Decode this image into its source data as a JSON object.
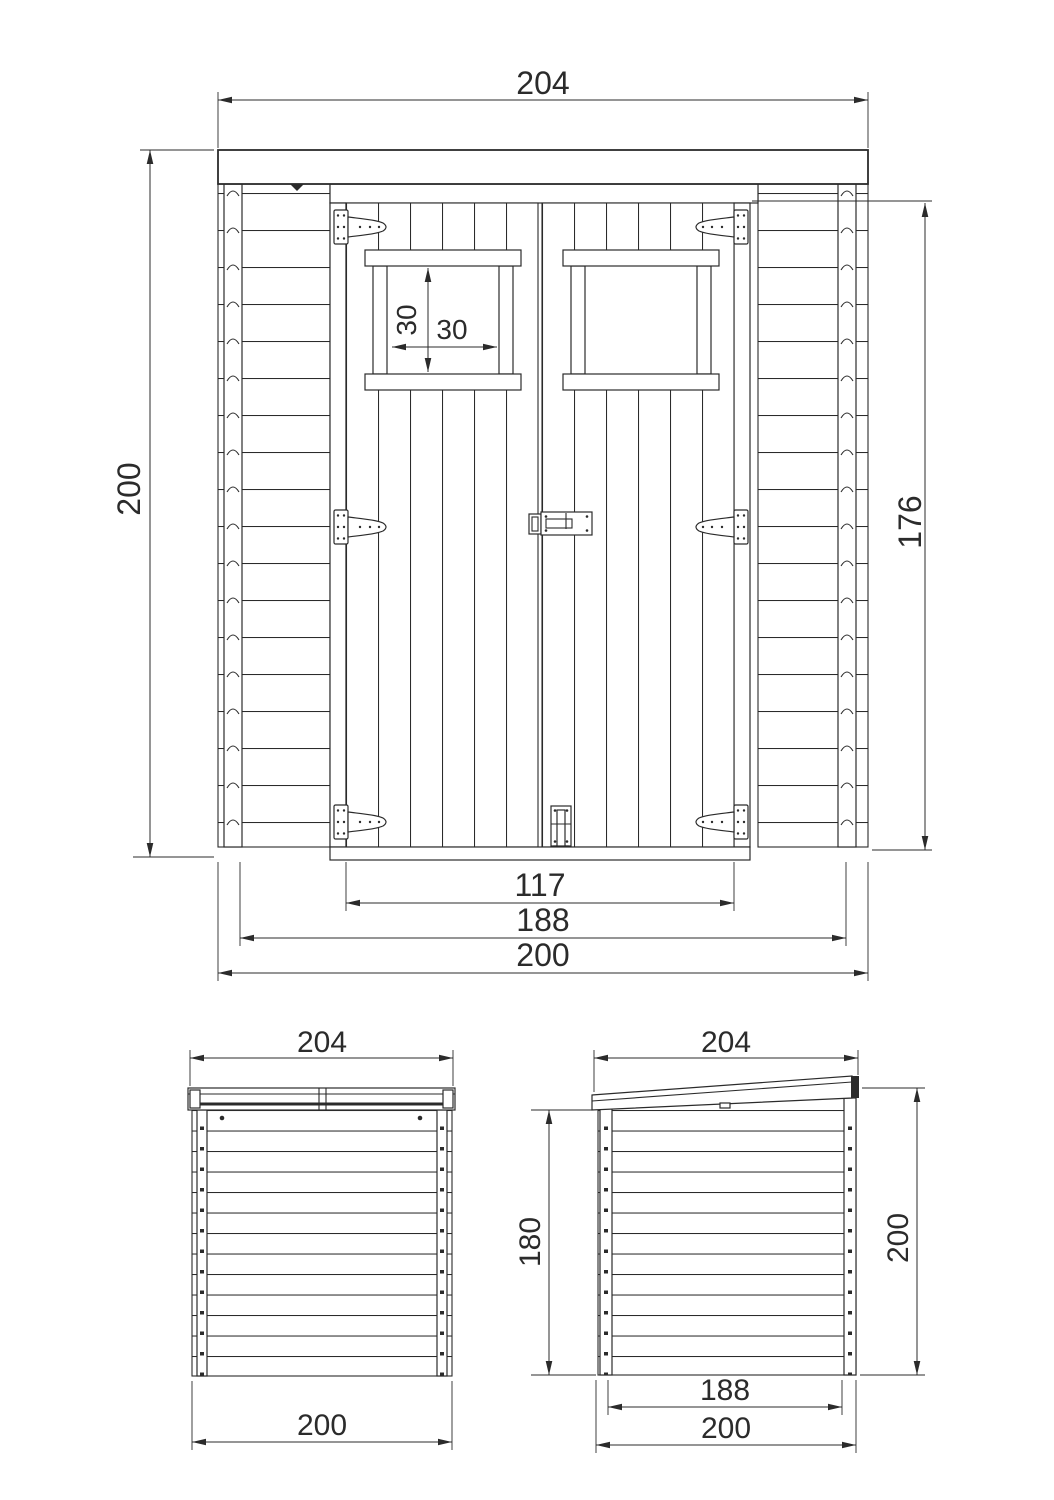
{
  "front_view": {
    "width_top": "204",
    "height_left": "200",
    "height_right": "176",
    "window_height": "30",
    "window_width": "30",
    "door_opening_width": "117",
    "frame_width": "188",
    "base_width": "200"
  },
  "back_view": {
    "width_top": "204",
    "base_width": "200"
  },
  "side_view": {
    "width_top": "204",
    "height_left": "180",
    "height_right": "200",
    "frame_width": "188",
    "base_width": "200"
  },
  "colors": {
    "line": "#2b2b2b",
    "background": "#ffffff",
    "border": "#cdd1d4"
  }
}
